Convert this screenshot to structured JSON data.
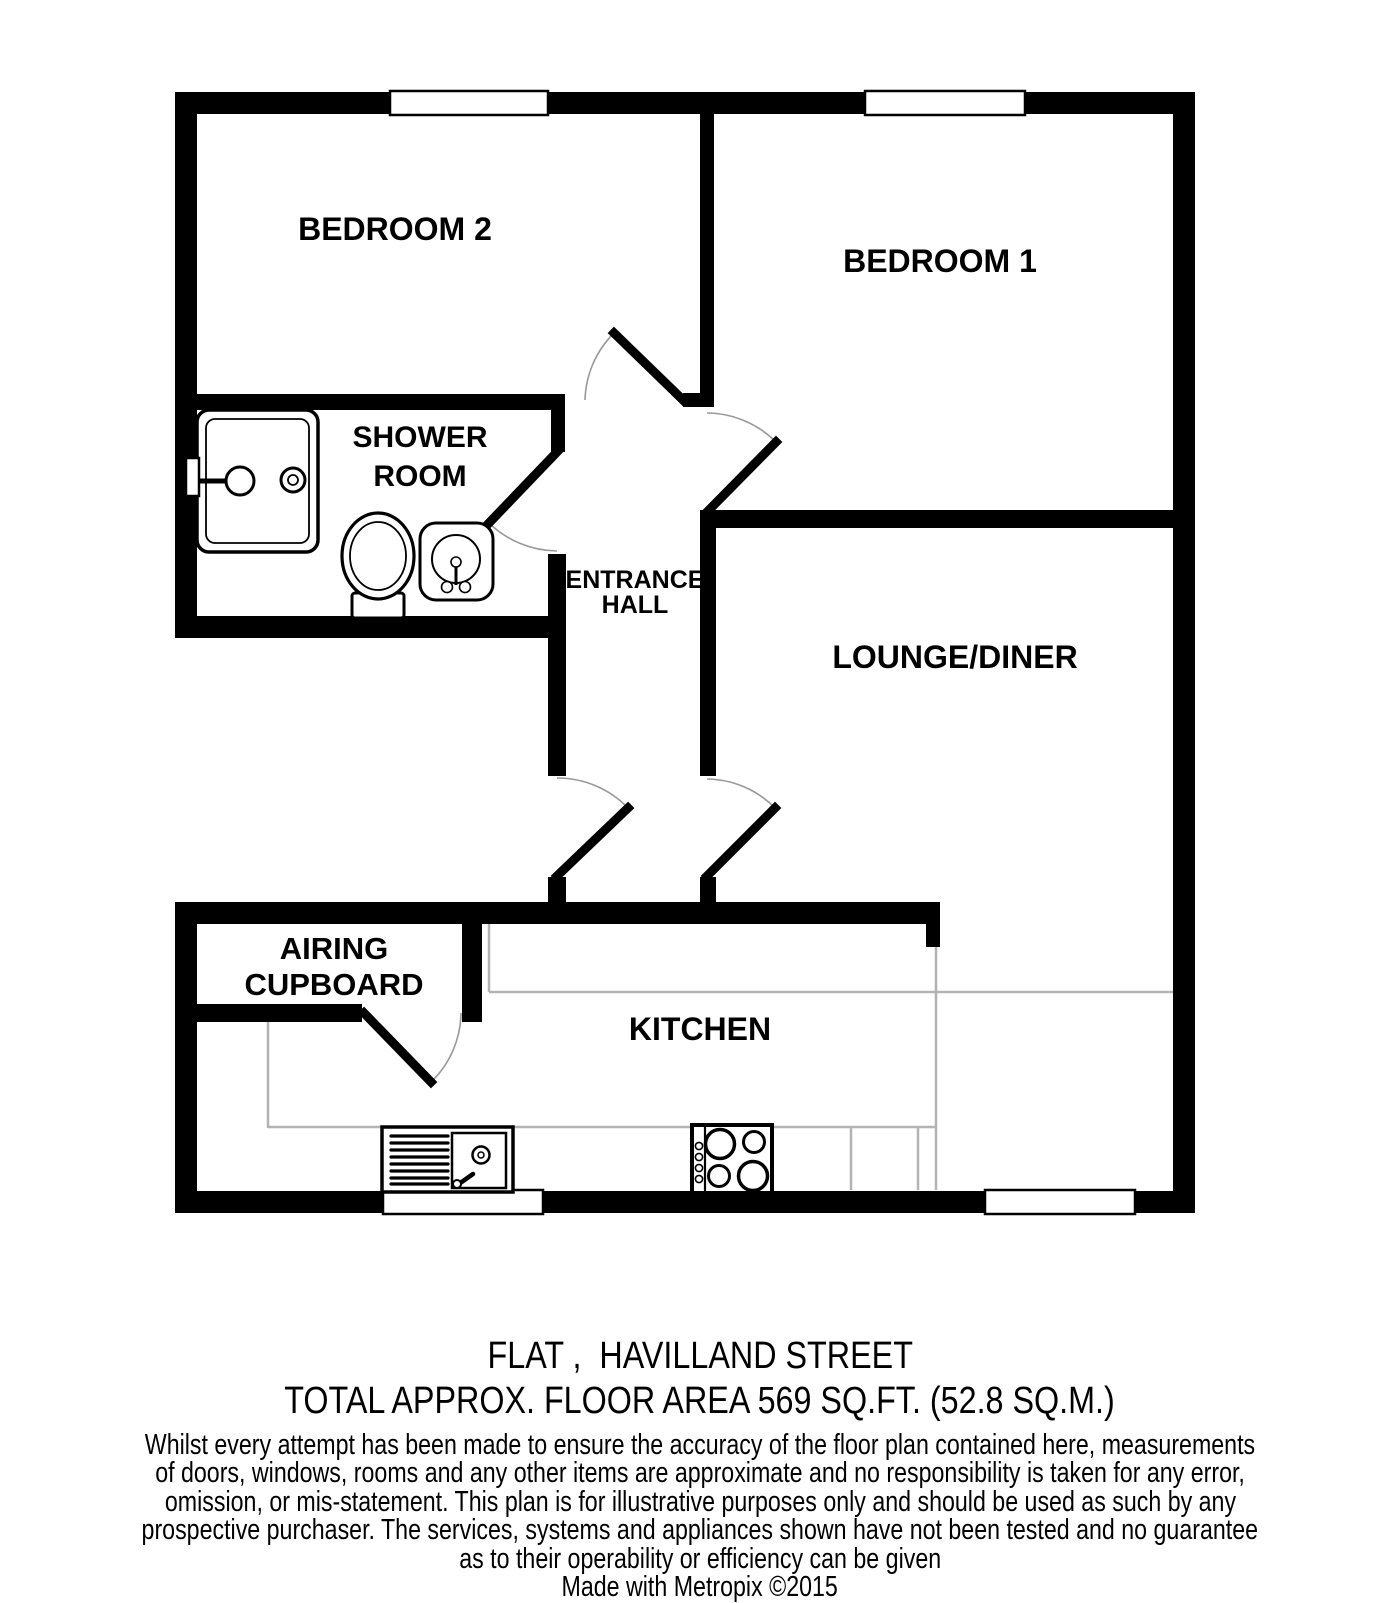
{
  "plan_type": "flat-floorplan",
  "rooms": {
    "bedroom2": {
      "label": "BEDROOM 2"
    },
    "bedroom1": {
      "label": "BEDROOM 1"
    },
    "shower_room": {
      "line1": "SHOWER",
      "line2": "ROOM"
    },
    "entrance_hall": {
      "line1": "ENTRANCE",
      "line2": "HALL"
    },
    "lounge_diner": {
      "label": "LOUNGE/DINER"
    },
    "airing_cupboard": {
      "line1": "AIRING",
      "line2": "CUPBOARD"
    },
    "kitchen": {
      "label": "KITCHEN"
    }
  },
  "fixtures": [
    "shower-tray-icon",
    "toilet-icon",
    "wash-basin-icon",
    "kitchen-sink-icon",
    "hob-icon"
  ],
  "windows_count": 4,
  "doors_count": 6,
  "colors": {
    "wall": "#000000",
    "counter": "#b3b3b3",
    "door_arc": "#999999",
    "background": "#ffffff",
    "text": "#000000"
  },
  "footer": {
    "address": "FLAT ,  HAVILLAND STREET",
    "area": "TOTAL APPROX. FLOOR AREA 569 SQ.FT. (52.8 SQ.M.)",
    "disclaimer_lines": [
      "Whilst every attempt has been made to ensure the accuracy of the floor plan contained here, measurements",
      "of doors, windows, rooms and any other items are approximate and no responsibility is taken for any error,",
      "omission, or mis-statement. This plan is for illustrative purposes only and should be used as such by any",
      "prospective purchaser. The services, systems and appliances shown have not been tested and no guarantee",
      "as to their operability or efficiency can be given"
    ],
    "credit": "Made with Metropix ©2015"
  }
}
